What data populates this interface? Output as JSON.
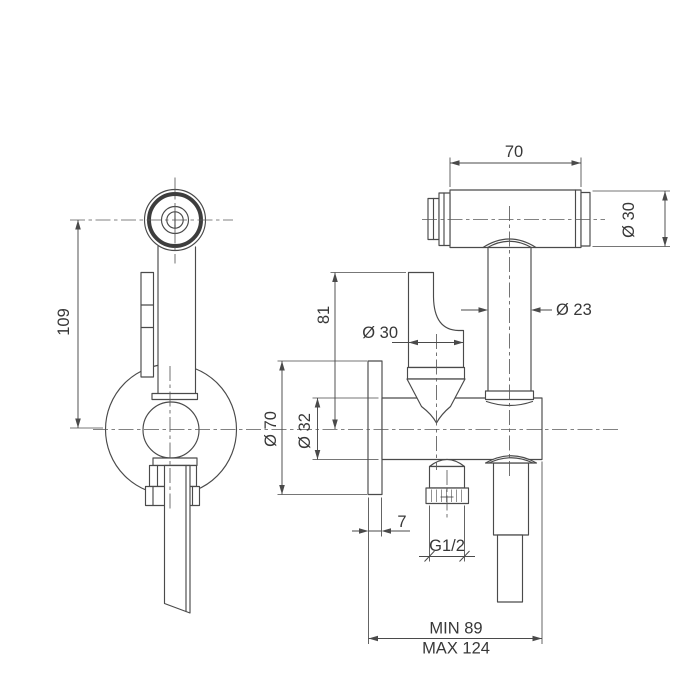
{
  "drawing_type": "technical dimension drawing of wall-mounted bidet hand shower set",
  "colors": {
    "background": "#ffffff",
    "line": "#4a4a4a",
    "text": "#383838"
  },
  "dimensions": {
    "spray_head_length": "70",
    "spray_head_diameter": "Ø 30",
    "holder_tube_diameter": "Ø 23",
    "valve_stem_height": "81",
    "handle_knob_diameter": "Ø 30",
    "wall_flange_diameter": "Ø 70",
    "valve_body_diameter": "Ø 32",
    "handset_length": "109",
    "wall_plate_thickness": "7",
    "outlet_thread_size": "G1/2",
    "installation_depth_min": "MIN 89",
    "installation_depth_max": "MAX 124"
  }
}
